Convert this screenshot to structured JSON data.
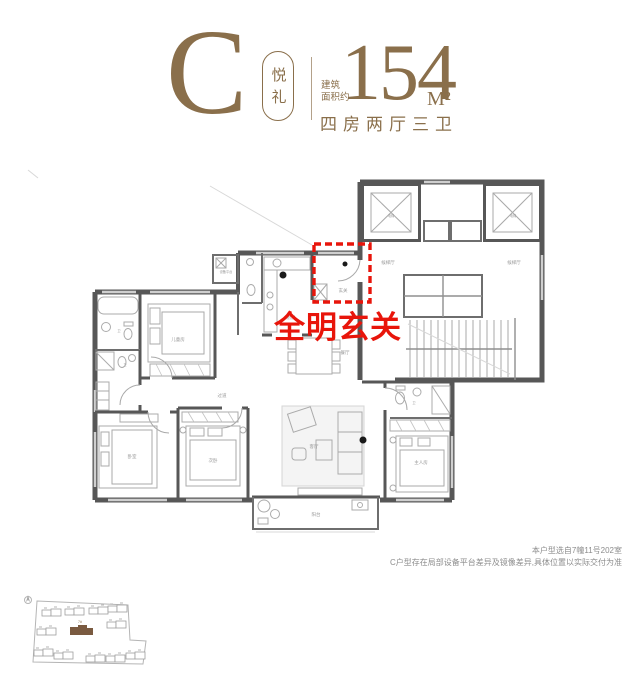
{
  "header": {
    "type_letter": "C",
    "type_name": "悦礼",
    "area_prefix_line1": "建筑",
    "area_prefix_line2": "面积约",
    "area_value": "154",
    "area_unit": "M²",
    "layout": "四房两厅三卫"
  },
  "callout": {
    "text": "全明玄关"
  },
  "floor_plan": {
    "labels": [
      "电梯",
      "电梯",
      "候梯厅",
      "候梯厅",
      "玄关",
      "设备平台",
      "厨房",
      "儿童房",
      "过道",
      "卧室",
      "次卧",
      "客厅",
      "餐厅",
      "主人房",
      "阳台",
      "卫",
      "卫",
      "卫"
    ]
  },
  "site_plan": {
    "highlight_building": "7#"
  },
  "notes": {
    "line1": "本户型选自7幢11号202室",
    "line2": "C户型存在局部设备平台差异及镜像差异,具体位置以实际交付为准"
  },
  "colors": {
    "brand_brown": "#8a6f4b",
    "wall_gray": "#575757",
    "highlight_red": "#e8150b",
    "site_highlight_brown": "#7a5a40"
  }
}
